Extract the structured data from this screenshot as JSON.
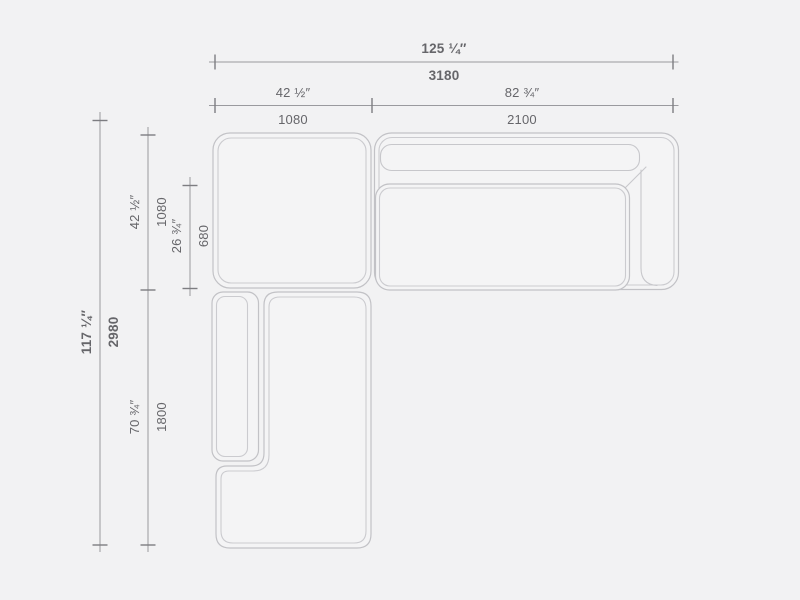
{
  "dimensions": {
    "overall_width": {
      "inches": "125 ¼″",
      "mm": "3180"
    },
    "corner_width": {
      "inches": "42 ½″",
      "mm": "1080"
    },
    "sofa_width": {
      "inches": "82 ¾″",
      "mm": "2100"
    },
    "overall_depth": {
      "inches": "117 ¼″",
      "mm": "2980"
    },
    "corner_depth": {
      "inches": "42 ½″",
      "mm": "1080"
    },
    "seat_depth": {
      "inches": "26 ¾″",
      "mm": "680"
    },
    "chaise_length": {
      "inches": "70 ¾″",
      "mm": "1800"
    }
  },
  "colors": {
    "background": "#f2f2f3",
    "module_fill": "#f4f4f5",
    "furniture_outline": "#c2c2c6",
    "furniture_outline_inner": "#cbcbcf",
    "dimension_line": "#9a9a9e",
    "dimension_tick": "#7d7d81",
    "text": "#66666a"
  }
}
